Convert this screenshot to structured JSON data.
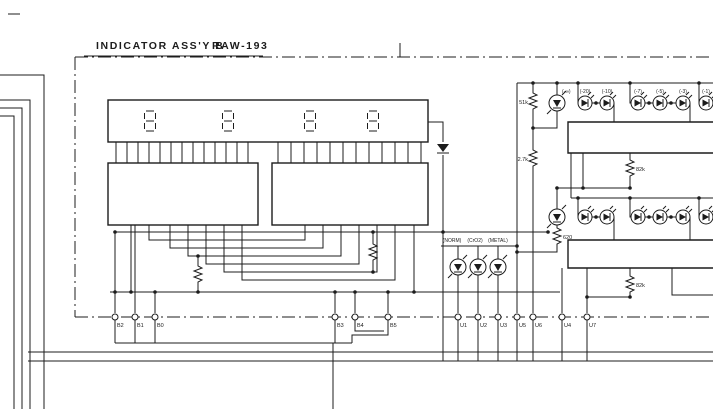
{
  "schematic": {
    "title": "INDICATOR ASS'Y B",
    "part_number": "RAW-193",
    "display": {
      "digits": [
        "8",
        "8",
        "8",
        "8"
      ]
    },
    "tape_type_labels": [
      "(NORM)",
      "(CrO2)",
      "(METAL)"
    ],
    "meter_scale_labels": [
      "(-∞)",
      "(-20)",
      "(-10)",
      "(-7)",
      "(-5)",
      "(-3)",
      "(-1)"
    ],
    "resistor_labels": {
      "r1": "51k",
      "r2": "2.7k",
      "r3": "82k",
      "r4": "620",
      "r5": "82k"
    },
    "connector_labels": {
      "b": [
        "B2",
        "B1",
        "B0",
        "B3",
        "B4",
        "B5"
      ],
      "u": [
        "U1",
        "U2",
        "U3",
        "U5",
        "U6",
        "U4",
        "U7"
      ]
    },
    "colors": {
      "ink": "#1c1c1c",
      "paper": "#ffffff"
    }
  }
}
